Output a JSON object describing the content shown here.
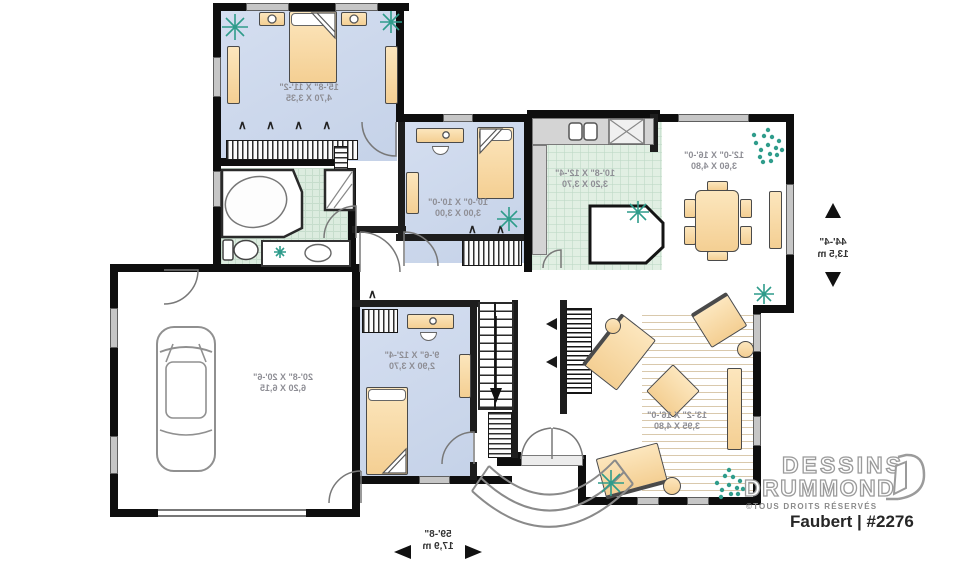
{
  "brand": {
    "name_line1": "DESSINS",
    "name_line2": "DRUMMOND",
    "rights": "©TOUS DROITS RÉSERVÉS",
    "plan_label": "Faubert | #2276"
  },
  "overall_dimensions": {
    "width_ft": "59'-8\"",
    "width_m": "17,9 m",
    "depth_ft": "44'-4\"",
    "depth_m": "13,5 m"
  },
  "rooms": [
    {
      "id": "master-bedroom",
      "imperial": "15'-8\" X 11'-2\"",
      "metric": "4,70 X 3,35"
    },
    {
      "id": "bedroom-2",
      "imperial": "10'-0\" X 10'-0\"",
      "metric": "3,00 X 3,00"
    },
    {
      "id": "kitchen",
      "imperial": "10'-8\" X 12'-4\"",
      "metric": "3,20 X 3,70"
    },
    {
      "id": "dining-room",
      "imperial": "12'-0\" X 16'-0\"",
      "metric": "3,60 X 4,80"
    },
    {
      "id": "living-room",
      "imperial": "13'-2\" X 16'-0\"",
      "metric": "3,95 X 4,80"
    },
    {
      "id": "bedroom-3",
      "imperial": "9'-6\" X 12'-4\"",
      "metric": "2,90 X 3,70"
    },
    {
      "id": "garage",
      "imperial": "20'-8\" X 20'-6\"",
      "metric": "6,20 X 6,15"
    }
  ],
  "icons": {
    "bifold_quad": "∧ ∧ ∧ ∧",
    "bifold_double": "∧ ∧",
    "bifold_single": "∧"
  },
  "colors": {
    "wall": "#0e0e0e",
    "bedroom_floor": "#ccd7ea",
    "tile_floor": "#dcecdf",
    "furniture": "#f6d29b",
    "plant": "#2f9c8b"
  }
}
